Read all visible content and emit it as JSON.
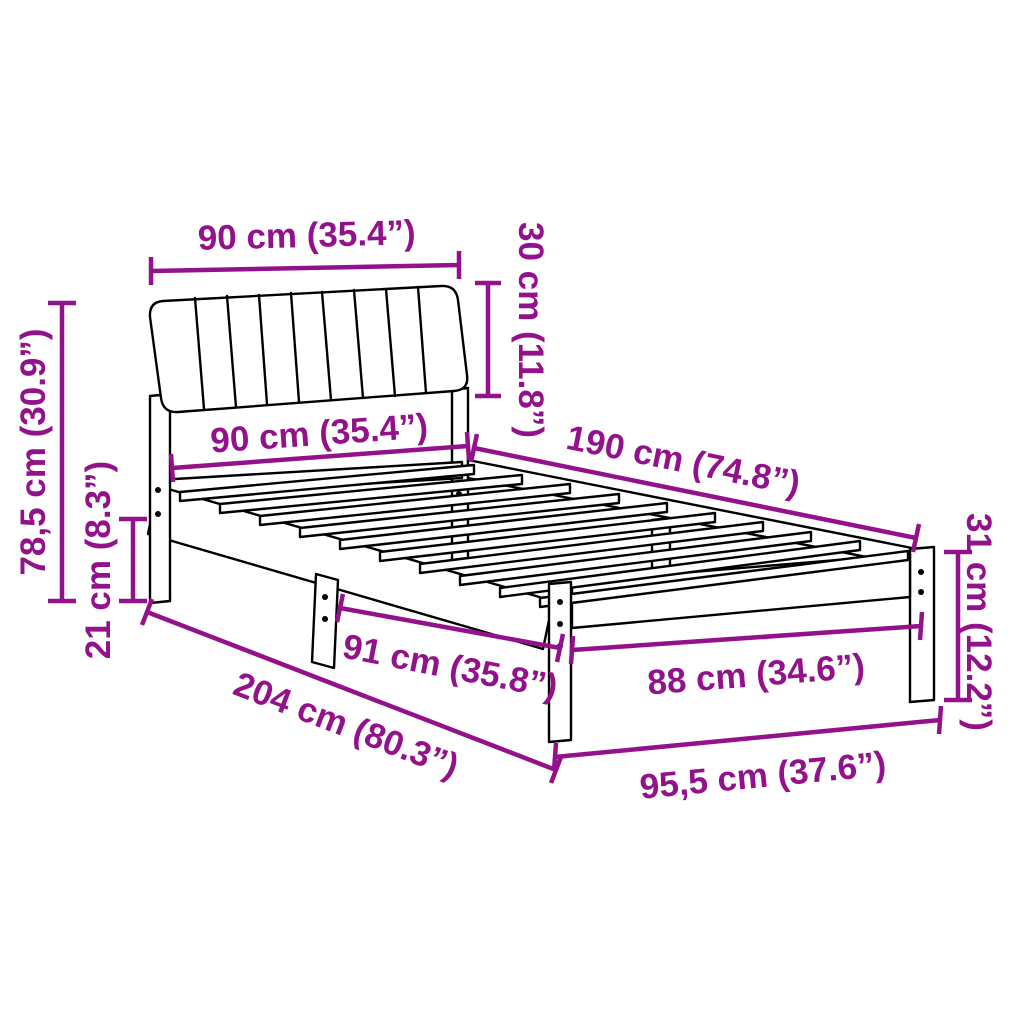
{
  "diagram": {
    "type": "product-dimension-diagram",
    "product": "bed frame with channel-tufted headboard and slatted base",
    "background_color": "#ffffff",
    "outline_color": "#000000",
    "dimension_color": "#93128B",
    "units": [
      "cm",
      "inches"
    ],
    "dimensions": [
      {
        "id": "headboard-width",
        "label": "90 cm (35.4”)",
        "value_cm": 90,
        "value_in": 35.4,
        "orientation": "horizontal-top"
      },
      {
        "id": "headboard-height",
        "label": "30 cm (11.8”)",
        "value_cm": 30,
        "value_in": 11.8,
        "orientation": "vertical-right-of-headboard"
      },
      {
        "id": "bed-width-head",
        "label": "90 cm (35.4”)",
        "value_cm": 90,
        "value_in": 35.4,
        "orientation": "horizontal-under-headboard"
      },
      {
        "id": "bed-length",
        "label": "190 cm (74.8”)",
        "value_cm": 190,
        "value_in": 74.8,
        "orientation": "diagonal-far-side"
      },
      {
        "id": "total-height",
        "label": "78,5 cm (30.9”)",
        "value_cm": 78.5,
        "value_in": 30.9,
        "orientation": "vertical-far-left"
      },
      {
        "id": "head-leg-height",
        "label": "21 cm (8.3”)",
        "value_cm": 21,
        "value_in": 8.3,
        "orientation": "vertical-left"
      },
      {
        "id": "total-length",
        "label": "204 cm (80.3”)",
        "value_cm": 204,
        "value_in": 80.3,
        "orientation": "diagonal-near-side"
      },
      {
        "id": "leg-span-side",
        "label": "91 cm (35.8”)",
        "value_cm": 91,
        "value_in": 35.8,
        "orientation": "diagonal-between-legs"
      },
      {
        "id": "leg-span-foot",
        "label": "88 cm (34.6”)",
        "value_cm": 88,
        "value_in": 34.6,
        "orientation": "horizontal-foot-inner"
      },
      {
        "id": "total-width",
        "label": "95,5 cm (37.6”)",
        "value_cm": 95.5,
        "value_in": 37.6,
        "orientation": "horizontal-foot-outer"
      },
      {
        "id": "foot-leg-height",
        "label": "31 cm (12.2”)",
        "value_cm": 31,
        "value_in": 12.2,
        "orientation": "vertical-far-right"
      }
    ]
  }
}
